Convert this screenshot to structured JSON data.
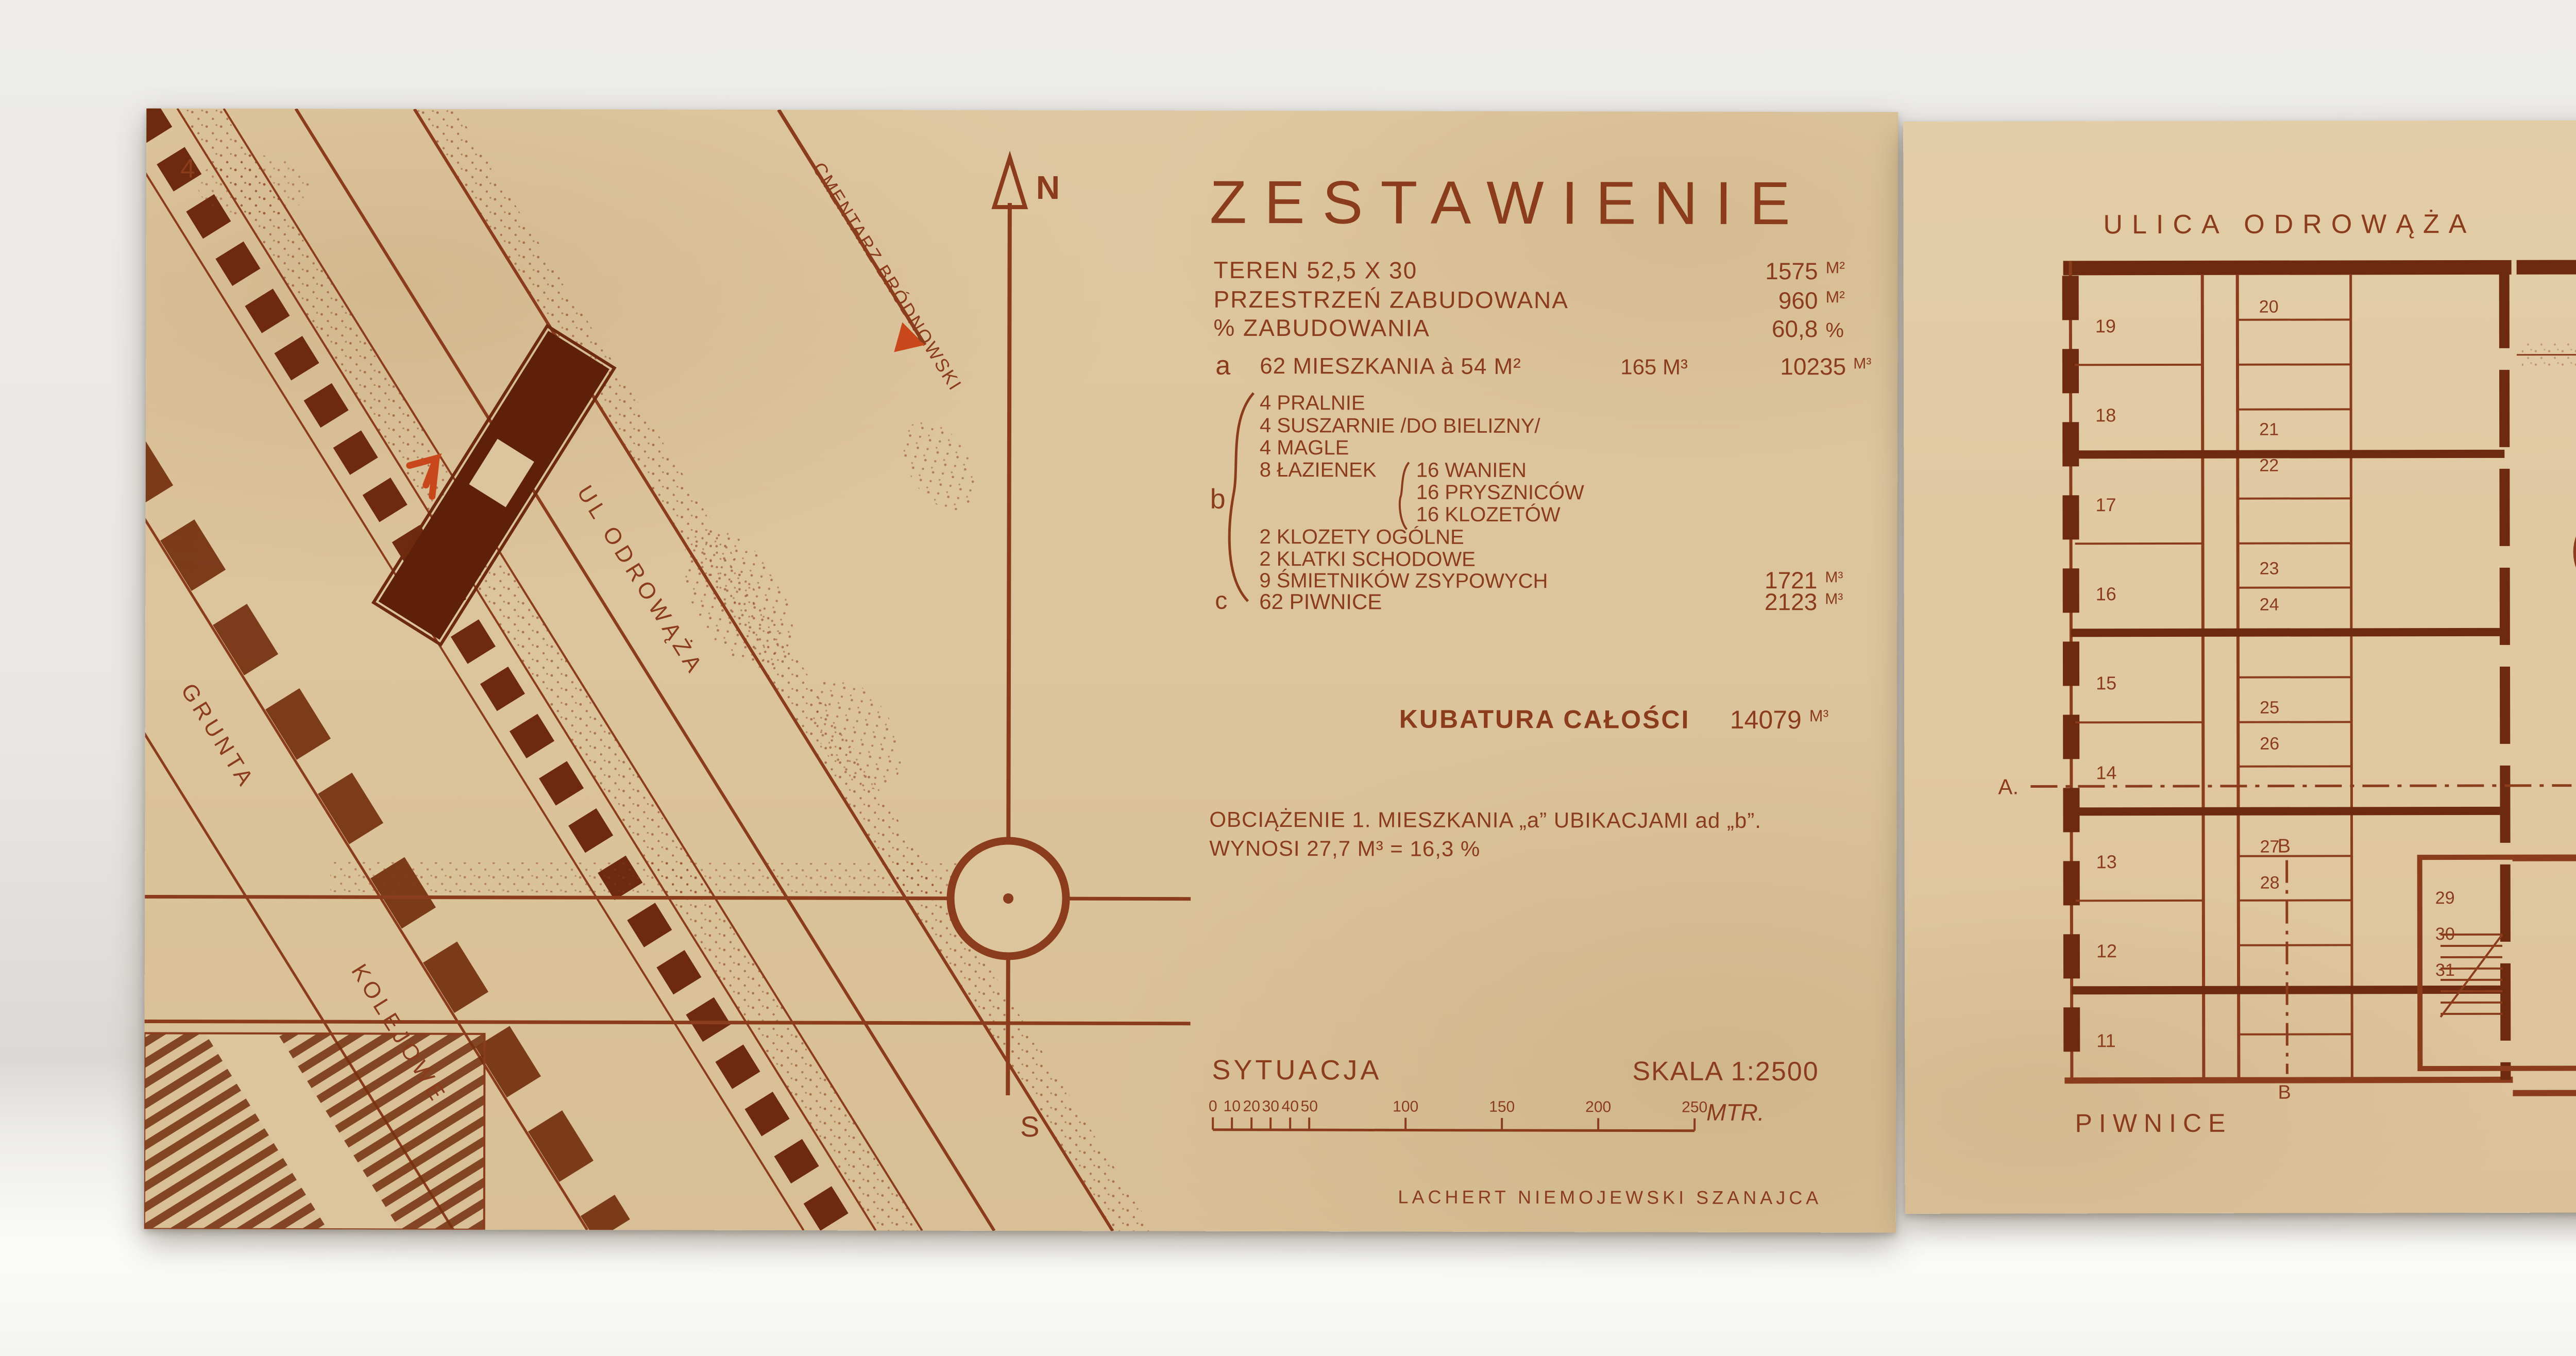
{
  "palette": {
    "board_left": "#dcc49c",
    "board_right": "#e0c8a1",
    "ink": "#8a3c1c",
    "ink_dark": "#6e2a0f",
    "accent": "#c8481b",
    "backdrop": "#e9e7e4",
    "table": "#fbfbf9"
  },
  "left_board": {
    "page_number": "4",
    "map": {
      "street_label": "UL ODROWĄŻA",
      "grunta_label": "GRUNTA",
      "kolejowe_label": "KOLEJOWE",
      "cmentarz_label": "CMENTARZ BRÓDNOWSKI",
      "compass_north": "N",
      "compass_south": "S"
    },
    "zestawienie": {
      "title": "ZESTAWIENIE",
      "rows": [
        {
          "label": "TEREN 52,5 X 30",
          "value": "1575",
          "unit": "M²"
        },
        {
          "label": "PRZESTRZEŃ ZABUDOWANA",
          "value": "960",
          "unit": "M²"
        },
        {
          "label": "% ZABUDOWANIA",
          "value": "60,8",
          "unit": "%"
        }
      ],
      "item_a": {
        "key": "a",
        "label": "62 MIESZKANIA à 54 M²",
        "per_unit": "165 M³",
        "value": "10235",
        "unit": "M³"
      },
      "item_b": {
        "key": "b",
        "lines": [
          "4 PRALNIE",
          "4 SUSZARNIE /DO BIELIZNY/",
          "4 MAGLE",
          "8 ŁAZIENEK",
          "16 WANIEN",
          "16 PRYSZNICÓW",
          "16 KLOZETÓW",
          "2 KLOZETY OGÓLNE",
          "2 KLATKI SCHODOWE",
          "9 ŚMIETNIKÓW ZSYPOWYCH"
        ],
        "value": "1721",
        "unit": "M³"
      },
      "item_c": {
        "key": "c",
        "label": "62 PIWNICE",
        "value": "2123",
        "unit": "M³"
      },
      "kubatura": {
        "label": "KUBATURA CAŁOŚCI",
        "value": "14079",
        "unit": "M³"
      },
      "load_line1": "OBCIĄŻENIE 1. MIESZKANIA „a” UBIKACJAMI ad „b”.",
      "load_line2": "WYNOSI 27,7 M³ = 16,3 %",
      "sytuacja": {
        "title": "SYTUACJA",
        "scale": "SKALA 1:2500",
        "ticks": [
          "0",
          "10",
          "20",
          "30",
          "40",
          "50",
          "100",
          "150",
          "200",
          "250"
        ],
        "unit": "MTR."
      },
      "signature": "LACHERT NIEMOJEWSKI SZANAJCA"
    }
  },
  "right_board": {
    "street": "ULICA ODROWĄŻA",
    "scale": {
      "label": "SKALA",
      "ticks": [
        "0",
        "1",
        "2",
        "3",
        "4",
        "5",
        "10"
      ],
      "unit": "MTR."
    },
    "courtyard": {
      "basen": "BASEN GŁĘB. 50cm DLA DZIECI",
      "trawnik": "TRAWNIK",
      "smietnik": "ŚMIETNIK"
    },
    "utilities": {
      "pralnia": "PRALNIA",
      "suszarnia": "SUSZARNIA",
      "magiel": "MAGIEL",
      "wc": "W.C. OGÓLNE",
      "sklad": "SKŁAD"
    },
    "piwnice": {
      "label": "PIWNICE",
      "rooms_left": [
        "19",
        "18",
        "17",
        "16",
        "15",
        "14",
        "13",
        "12",
        "11"
      ],
      "rooms_mid": [
        "20",
        "21",
        "22",
        "23",
        "24",
        "25",
        "26",
        "27",
        "28",
        "29",
        "30",
        "31"
      ],
      "section_a": "A.",
      "section_b": "B"
    },
    "parter": {
      "label": "PARTER"
    },
    "signature": "LACHERT NIEMOJEWSKI SZANAJCA"
  }
}
